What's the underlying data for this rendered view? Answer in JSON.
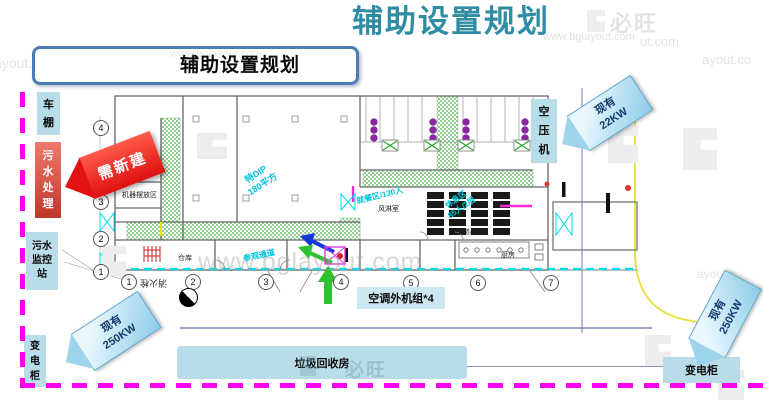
{
  "header": {
    "title": "辅助设置规划"
  },
  "subtitle": "辅助设置规划",
  "watermarks": {
    "brand": "必旺",
    "url": "www.bglayout.com",
    "url_cut1": "ut.com",
    "url_cut2": "ayout.co",
    "url_cut3": "ayout.com",
    "url_cut4": "ayout.c"
  },
  "side_labels": {
    "carport": "车棚",
    "sewage_treatment": "污水处理",
    "sewage_monitor": "污水监控站",
    "power_cabinet_left": "变电柜",
    "air_compressor": "空压机",
    "ac_outdoor_units": "空调外机组*4",
    "garbage_room": "垃圾回收房",
    "power_cabinet_right": "变电柜"
  },
  "banners": {
    "need_new_build": "需新建",
    "existing": "现有",
    "kw22": "22KW",
    "kw250": "250KW"
  },
  "axes": {
    "bottom": [
      "1",
      "2",
      "3",
      "4",
      "5",
      "6",
      "7"
    ],
    "left": [
      "4",
      "3",
      "2",
      "1"
    ]
  },
  "plan_labels": {
    "machine_area": "机器摆放区",
    "warehouse": "仓库",
    "kitchen": "厨房",
    "corridor": "通道/1.5m",
    "air_shower": "风淋室",
    "dining": "就餐区/130人",
    "rest_line1": "休息区",
    "rest_line2": "85人/2层",
    "dip_line1": "特DIP",
    "dip_line2": "180平方",
    "visit_corridor": "参观通道",
    "fire_hydrant": "消火栓"
  },
  "colors": {
    "title_teal": "#2f8da3",
    "frame_magenta": "#ff00f0",
    "label_blue": "#b9dde8",
    "banner_blue_border": "#5aa5cc",
    "alert_red": "#e01010",
    "corridor_green": "#90cf90",
    "plan_cyan": "#00dbe8",
    "machine_purple": "#8e24aa"
  }
}
